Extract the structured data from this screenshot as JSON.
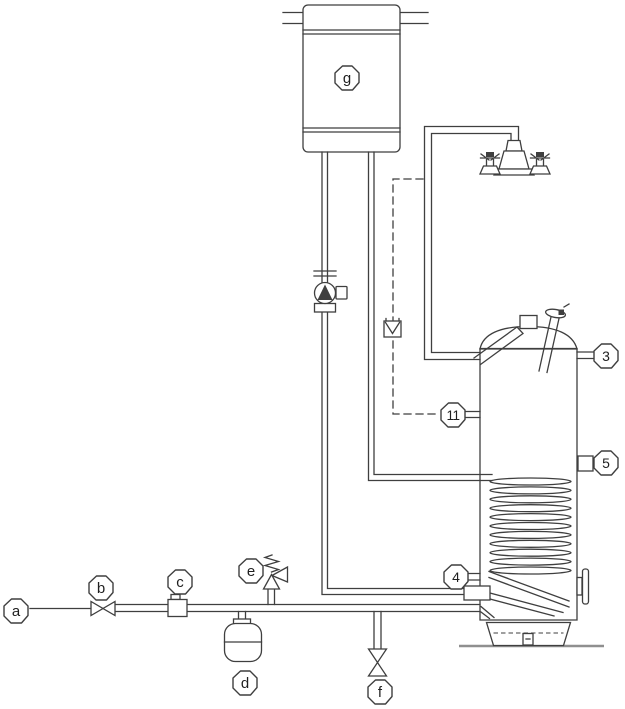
{
  "colors": {
    "line": "#3f3f3f",
    "bg": "#ffffff",
    "ground": "#8f8f8f",
    "text": "#1f1f1f"
  },
  "callouts": {
    "a": "a",
    "b": "b",
    "c": "c",
    "d": "d",
    "e": "e",
    "f": "f",
    "g": "g",
    "p3": "3",
    "p4": "4",
    "p5": "5",
    "p11": "11"
  }
}
